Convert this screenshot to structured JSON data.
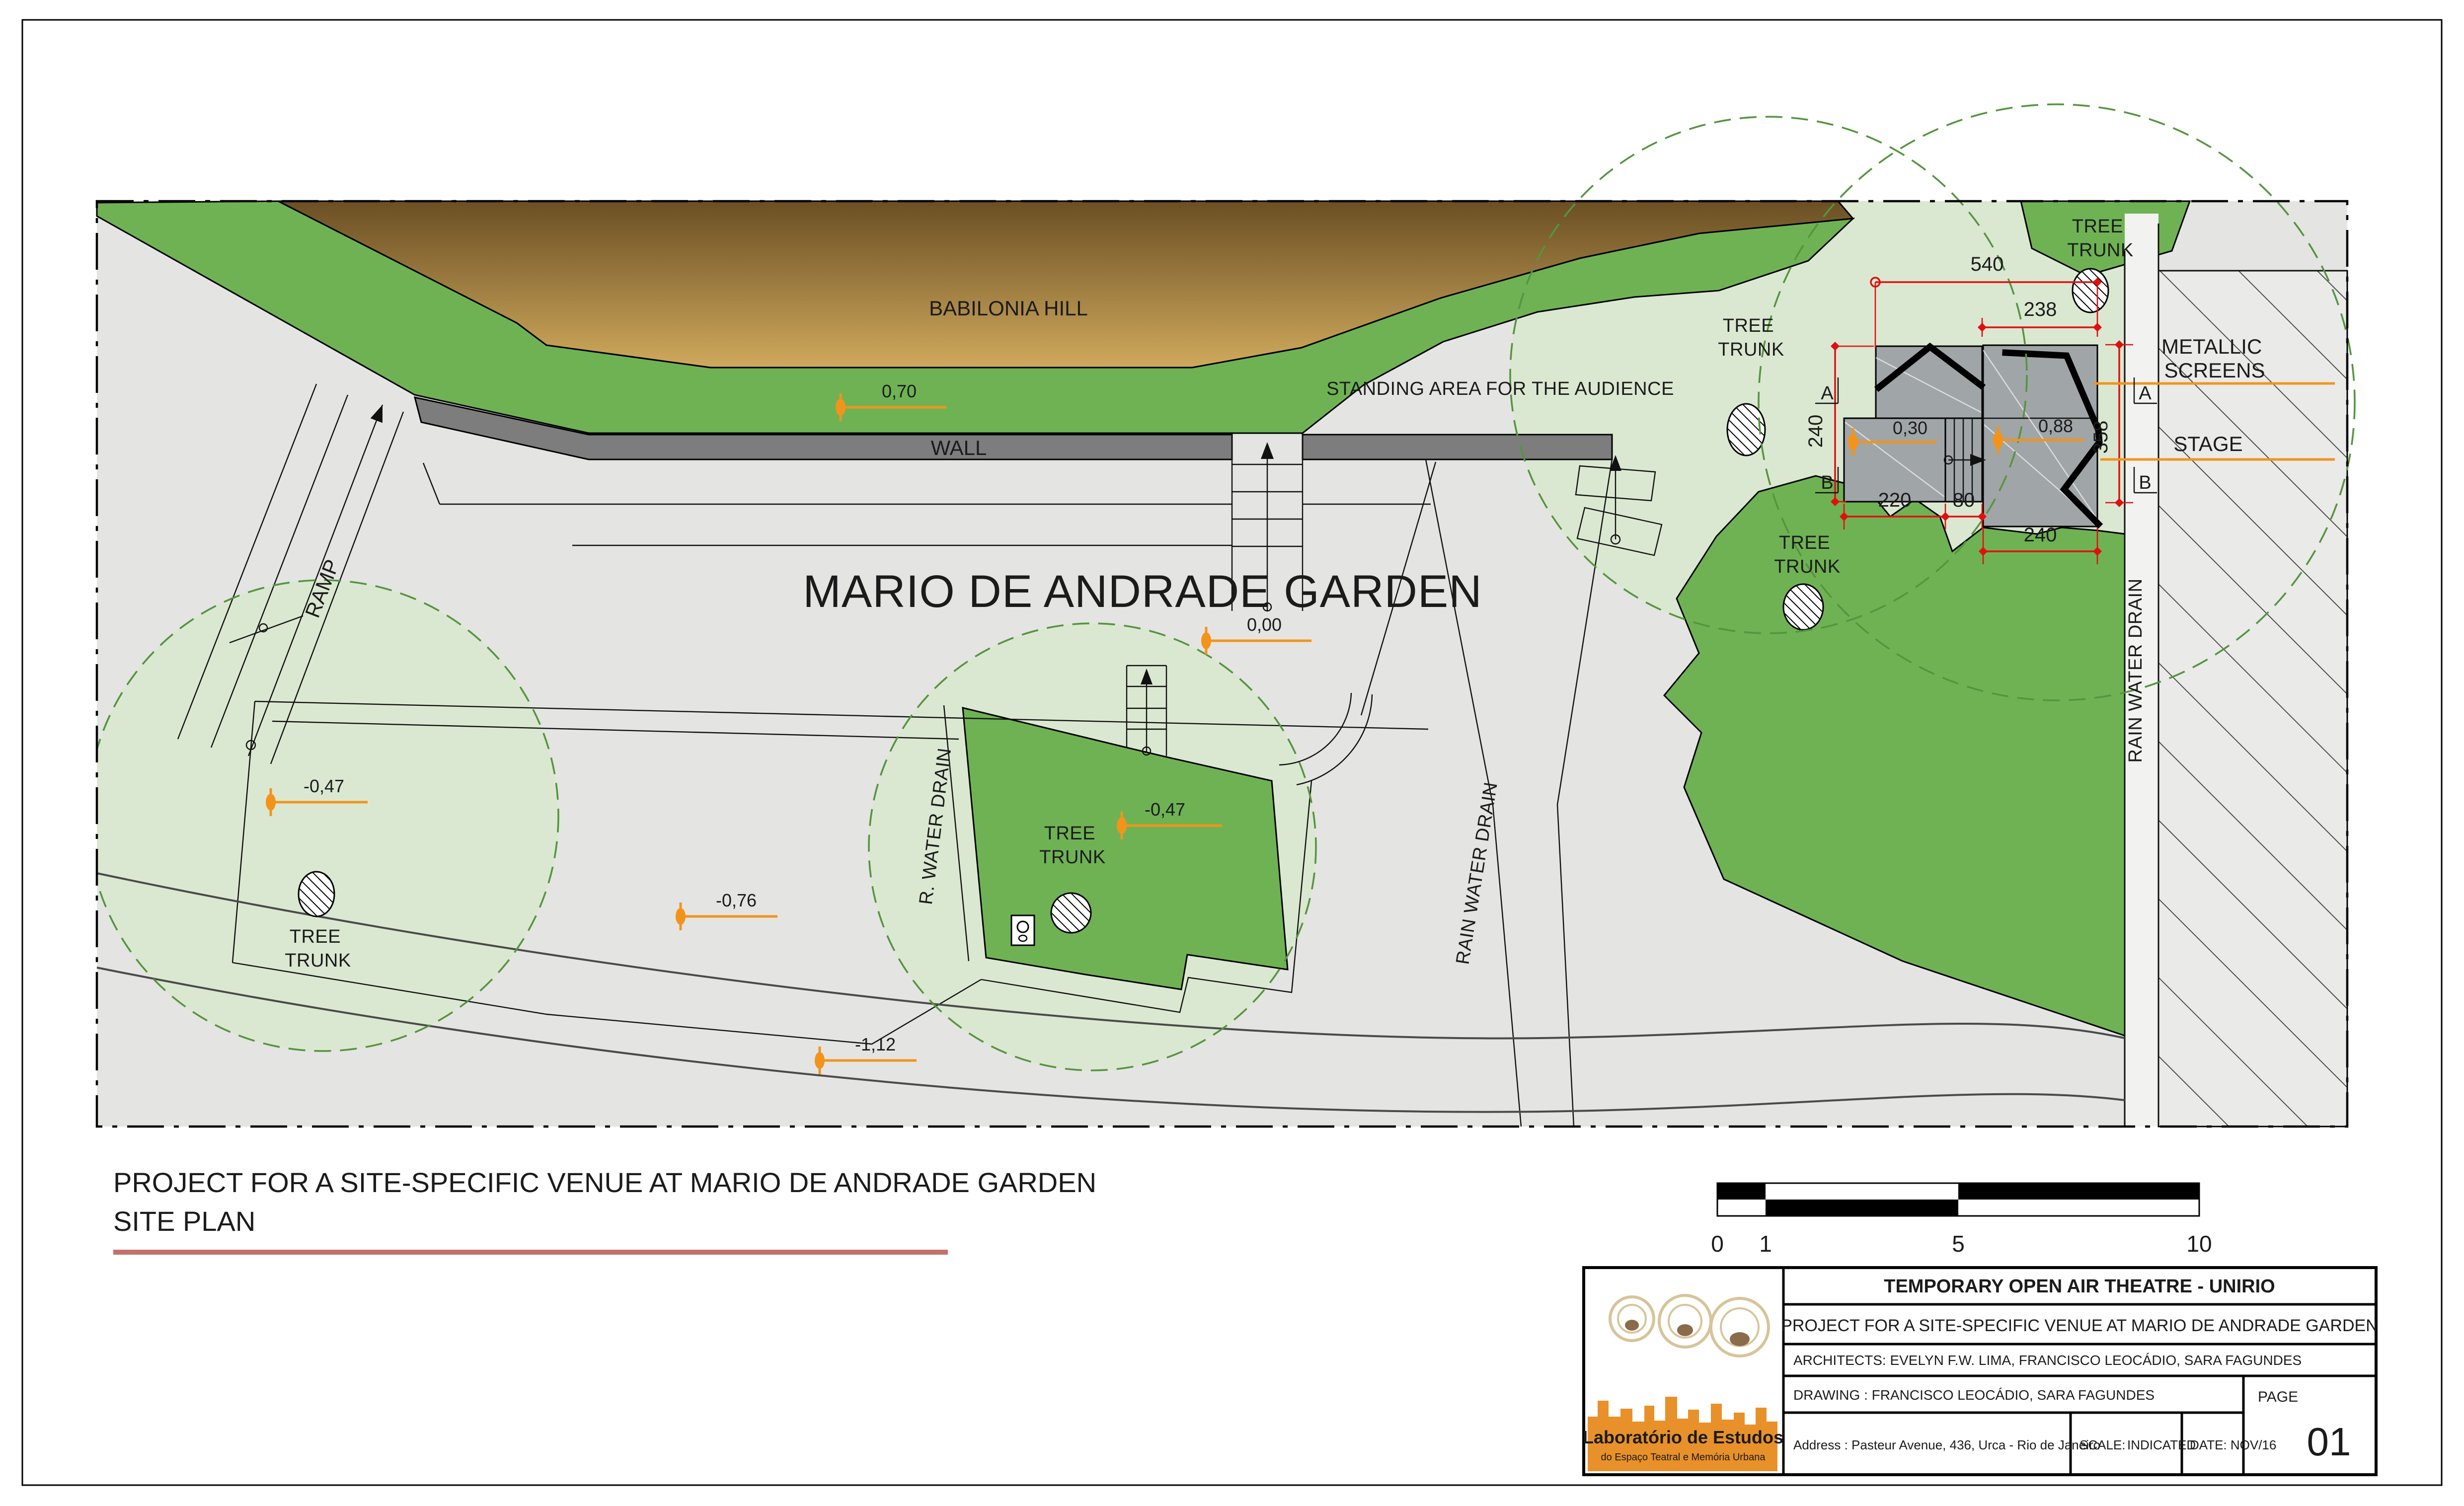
{
  "drawing": {
    "area_labels": {
      "babilonia_hill": "BABILONIA  HILL",
      "standing_area": "STANDING AREA FOR THE AUDIENCE",
      "garden_title": "MARIO  DE ANDRADE GARDEN",
      "wall": "WALL",
      "ramp": "RAMP",
      "metallic_screens_line1": "METALLIC",
      "metallic_screens_line2": "SCREENS",
      "stage": "STAGE",
      "rain_water_drain": "RAIN WATER DRAIN",
      "r_water_drain": "R. WATER DRAIN",
      "tree": "TREE",
      "trunk": "TRUNK"
    },
    "dimensions": {
      "top_width": "540",
      "stage_width": "238",
      "left_height": "240",
      "right_height": "358",
      "bottom_left": "220",
      "bottom_step": "80",
      "bottom_width": "240"
    },
    "sections": {
      "a": "A",
      "b": "B"
    },
    "elevations": {
      "e070": "0,70",
      "e000": "0,00",
      "e047": "-0,47",
      "e076": "-0,76",
      "e112": "-1,12",
      "e030": "0,30",
      "e088": "0,88"
    }
  },
  "scale_bar": {
    "t0": "0",
    "t1": "1",
    "t5": "5",
    "t10": "10"
  },
  "sheet": {
    "title": "PROJECT  FOR A SITE-SPECIFIC VENUE AT MARIO DE ANDRADE GARDEN",
    "subtitle": "SITE PLAN"
  },
  "title_block": {
    "project": "TEMPORARY OPEN AIR THEATRE - UNIRIO",
    "subject": "PROJECT  FOR A SITE-SPECIFIC VENUE AT MARIO DE ANDRADE GARDEN",
    "architects": "ARCHITECTS: EVELYN F.W. LIMA, FRANCISCO LEOCÁDIO, SARA FAGUNDES",
    "drawing": "DRAWING : FRANCISCO LEOCÁDIO, SARA FAGUNDES",
    "address": "Address : Pasteur Avenue, 436, Urca - Rio de Janeiro",
    "scale_label": "SCALE:",
    "scale_value": "INDICATED",
    "date": "DATE: NOV/16",
    "page_label": "PAGE",
    "page_number": "01",
    "logo_line1": "Laboratório de Estudos",
    "logo_line2": "do Espaço Teatral e Memória Urbana"
  },
  "colors": {
    "grass": "#6fb254",
    "canopy_fill": "#dbe8d1",
    "canopy_stroke": "#55953f",
    "hill_top": "#6b4f24",
    "hill_bottom": "#cfa95c",
    "wall_gray": "#7d7d7d",
    "platform_gray": "#a0a5a8",
    "ground_gray": "#e4e4e2",
    "dimension_red": "#e01010",
    "marker_orange": "#f2941c",
    "underline_red": "#c4716b",
    "logo_orange": "#e8912a"
  }
}
